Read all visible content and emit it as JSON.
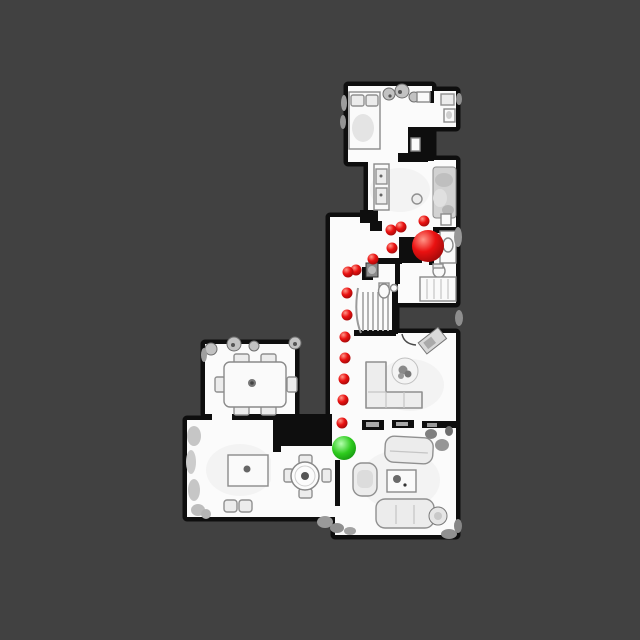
{
  "scene": {
    "description": "Top-down scanned house floor plan with a navigation path of waypoints between a start point and a goal point",
    "background_color": "#414141",
    "floor_color": "#fbfbfb",
    "wall_color": "#0e0e0e"
  },
  "palette": {
    "red_gradient": {
      "hi": "#ff9688",
      "mid": "#ea1111",
      "lo": "#8f0707"
    },
    "green_gradient": {
      "hi": "#b4ffae",
      "mid": "#2ecb1e",
      "lo": "#0f860d"
    }
  },
  "markers": {
    "goal": {
      "x": 428,
      "y": 246,
      "r": 16,
      "color": "#ea1111"
    },
    "start": {
      "x": 344,
      "y": 448,
      "r": 12,
      "color": "#2ecb1e"
    },
    "waypoint_radius": 5.5,
    "waypoint_color": "#ea1111",
    "waypoints": [
      {
        "x": 424,
        "y": 221
      },
      {
        "x": 401,
        "y": 227
      },
      {
        "x": 391,
        "y": 230
      },
      {
        "x": 392,
        "y": 248
      },
      {
        "x": 373,
        "y": 259
      },
      {
        "x": 356,
        "y": 270
      },
      {
        "x": 348,
        "y": 272
      },
      {
        "x": 347,
        "y": 293
      },
      {
        "x": 347,
        "y": 315
      },
      {
        "x": 345,
        "y": 337
      },
      {
        "x": 345,
        "y": 358
      },
      {
        "x": 344,
        "y": 379
      },
      {
        "x": 343,
        "y": 400
      },
      {
        "x": 342,
        "y": 423
      }
    ]
  }
}
